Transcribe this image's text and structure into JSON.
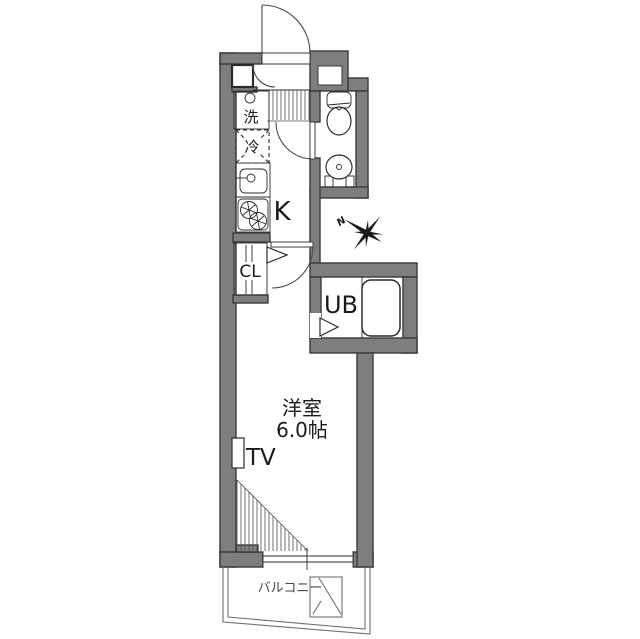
{
  "plan": {
    "type": "apartment-floor-plan",
    "labels": {
      "washer": "洗",
      "fridge": "冷",
      "kitchen": "K",
      "closet": "CL",
      "unit_bath": "UB",
      "room_name": "洋室",
      "room_size": "6.0帖",
      "tv": "TV",
      "balcony": "バルコニー",
      "north": "N"
    },
    "colors": {
      "wall_fill": "#7e7e7e",
      "wall_stroke": "#3a3a3a",
      "line": "#2b2b2b",
      "background": "#ffffff"
    }
  }
}
